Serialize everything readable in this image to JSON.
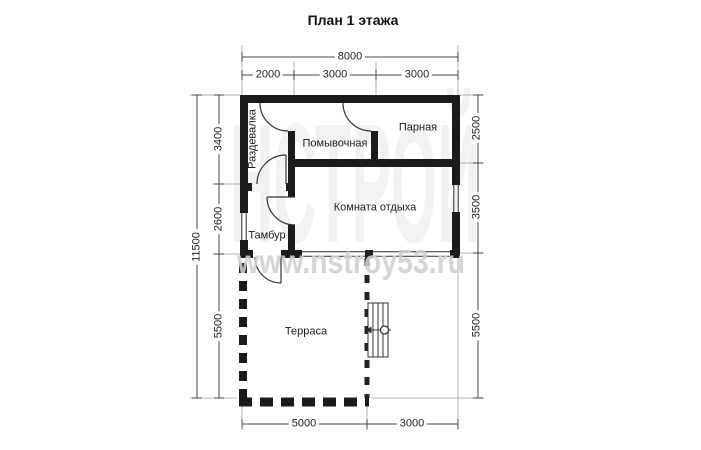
{
  "title": "План 1 этажа",
  "watermarks": {
    "brand": "НСТРОЙ",
    "site": "www.nstroy53.ru"
  },
  "rooms": {
    "razdevalka": "Раздевалка",
    "pomyvochnaya": "Помывочная",
    "parnaya": "Парная",
    "komnata_otdyha": "Комната отдыха",
    "tambur": "Тамбур",
    "terrasa": "Терраса"
  },
  "dimensions": {
    "top_total": "8000",
    "top_segments": [
      "2000",
      "3000",
      "3000"
    ],
    "left_total": "11500",
    "left_segments": [
      "3400",
      "2600",
      "5500"
    ],
    "right_segments": [
      "2500",
      "3500",
      "5500"
    ],
    "bottom_segments": [
      "5000",
      "3000"
    ]
  },
  "colors": {
    "wall": "#1b1b1b",
    "line": "#444444",
    "extension": "#999999",
    "watermark": "#cfcfcf"
  }
}
